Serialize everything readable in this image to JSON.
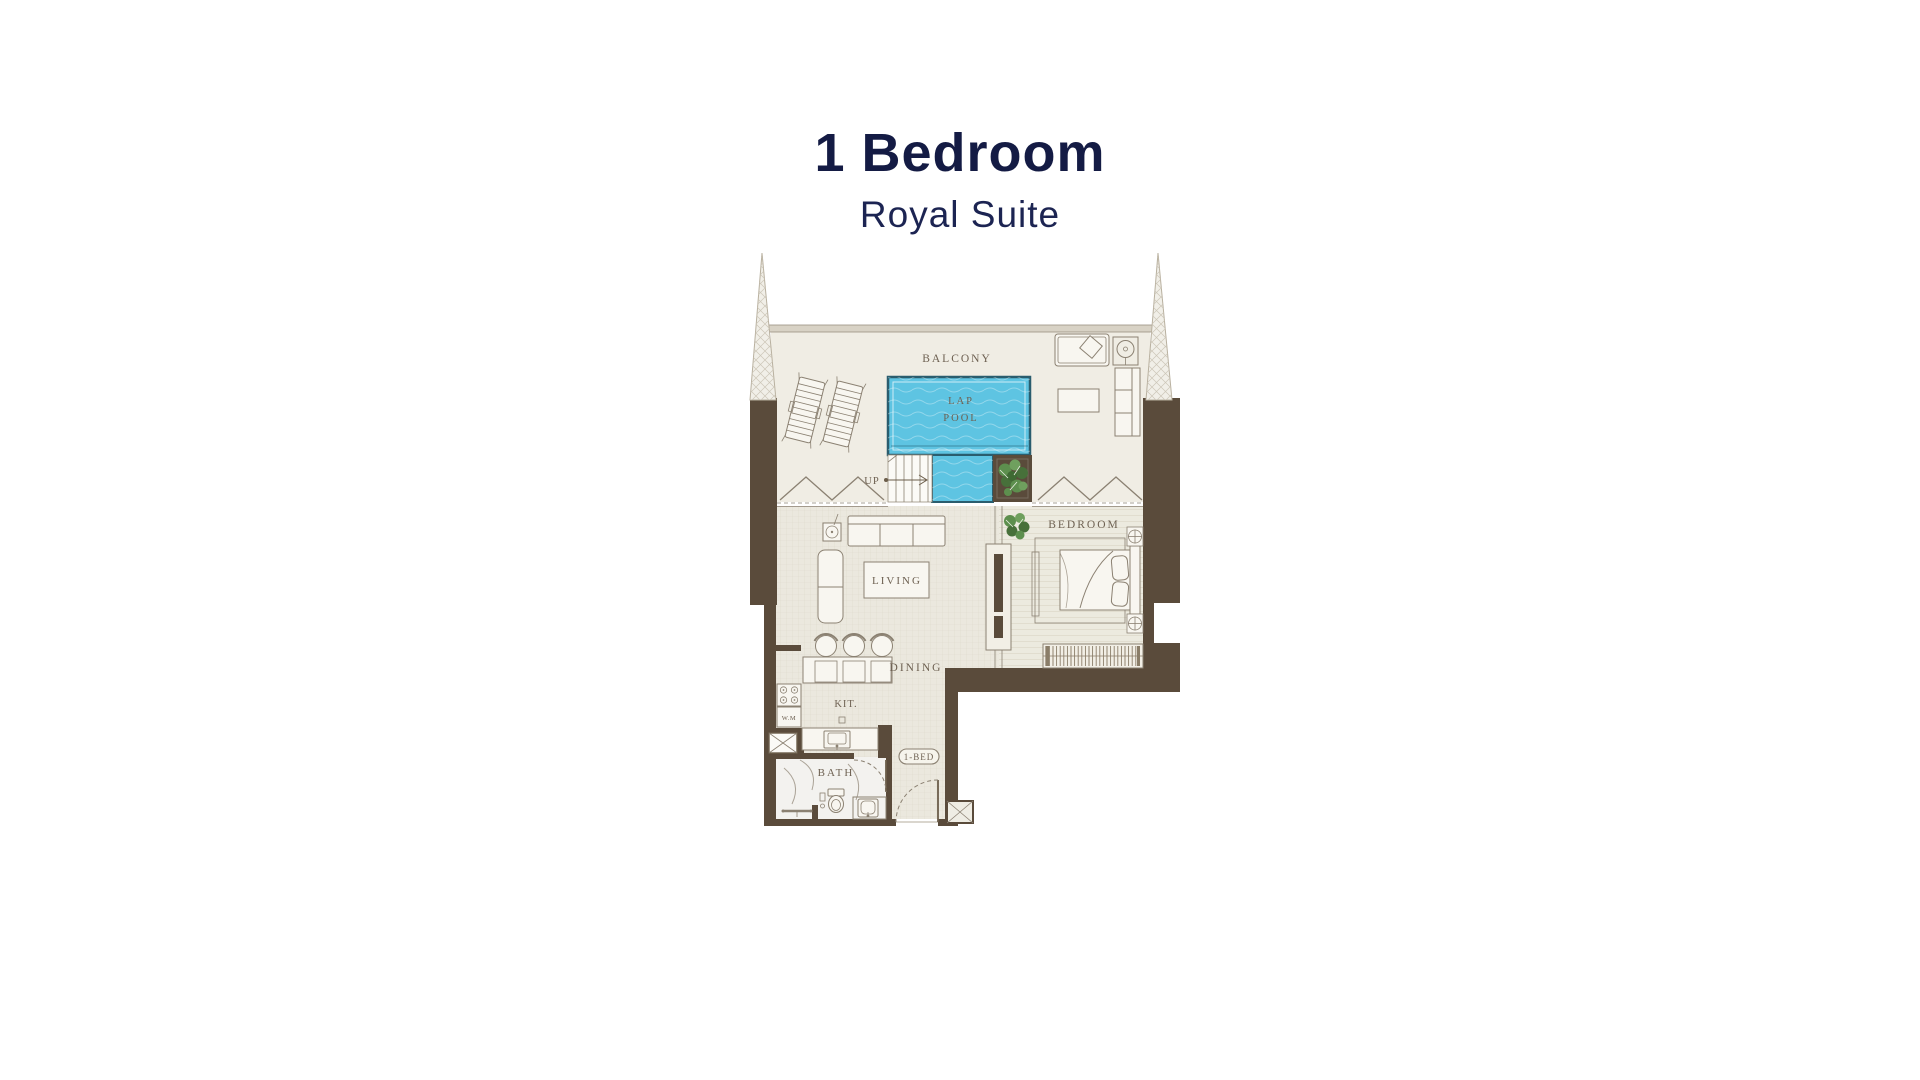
{
  "title": {
    "heading": "1 Bedroom",
    "subheading": "Royal Suite"
  },
  "floorplan": {
    "labels": {
      "balcony": "BALCONY",
      "lap": "LAP",
      "pool": "POOL",
      "up": "UP",
      "living": "LIVING",
      "bedroom": "BEDROOM",
      "dining": "DINING",
      "kitchen": "KIT.",
      "washing_machine": "W.M",
      "bath": "BATH",
      "unit_tag": "1-BED"
    }
  },
  "colors": {
    "title_main": "#141b44",
    "title_sub": "#1c2452",
    "wall": "#5a4b3b",
    "wall_light": "#d8d2c5",
    "line": "#8b8172",
    "label": "#6e6152",
    "water": "#5ec4e2",
    "pool_border": "#2a5d6e",
    "floor": "#ebe8de",
    "balcony_floor": "#f0ede4",
    "bedroom_floor": "#eceadf",
    "bath_floor": "#f3f2ef",
    "plant_green": "#5d8f4e",
    "plant_dark": "#47703a",
    "hatch_line": "#ccc6b8"
  }
}
